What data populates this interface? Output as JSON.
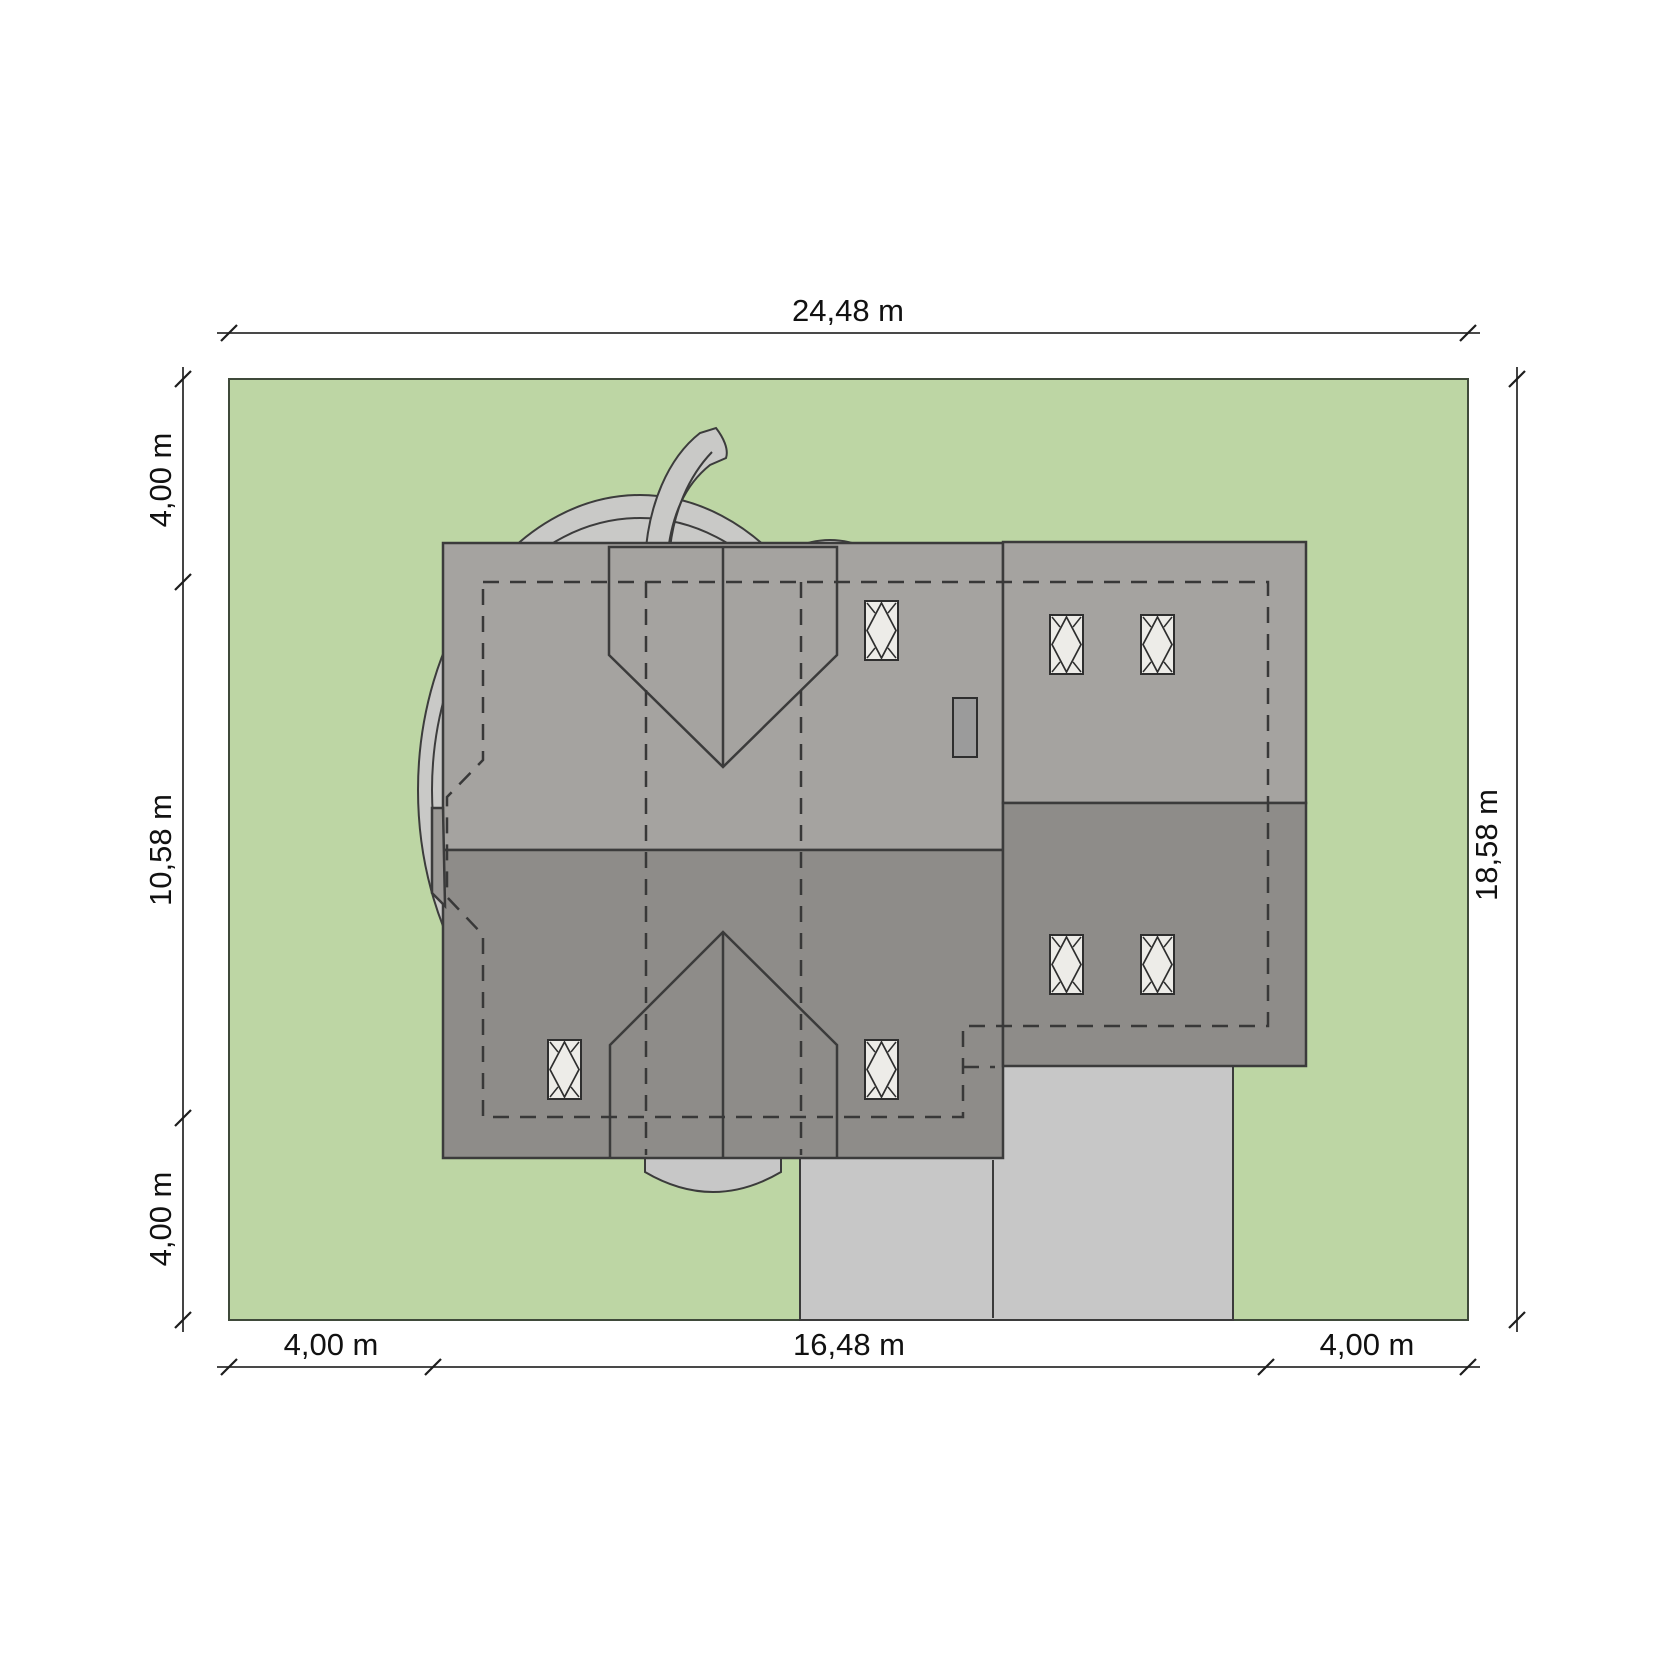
{
  "site_plan": {
    "dimensions": {
      "top_width": "24,48 m",
      "right_height": "18,58 m",
      "left": {
        "top": "4,00 m",
        "middle": "10,58 m",
        "bottom": "4,00 m"
      },
      "bottom": {
        "left": "4,00 m",
        "middle": "16,48 m",
        "right": "4,00 m"
      }
    },
    "colors": {
      "background": "#ffffff",
      "plot_green": "#bdd6a4",
      "roof_upper": "#a5a3a0",
      "roof_lower": "#8e8c89",
      "bay_roof": "#9b9996",
      "paving": "#c7c7c7",
      "vegetation": "#c9c9c7",
      "skylight": "#edece8",
      "chimney": "#9b9b9b"
    }
  }
}
